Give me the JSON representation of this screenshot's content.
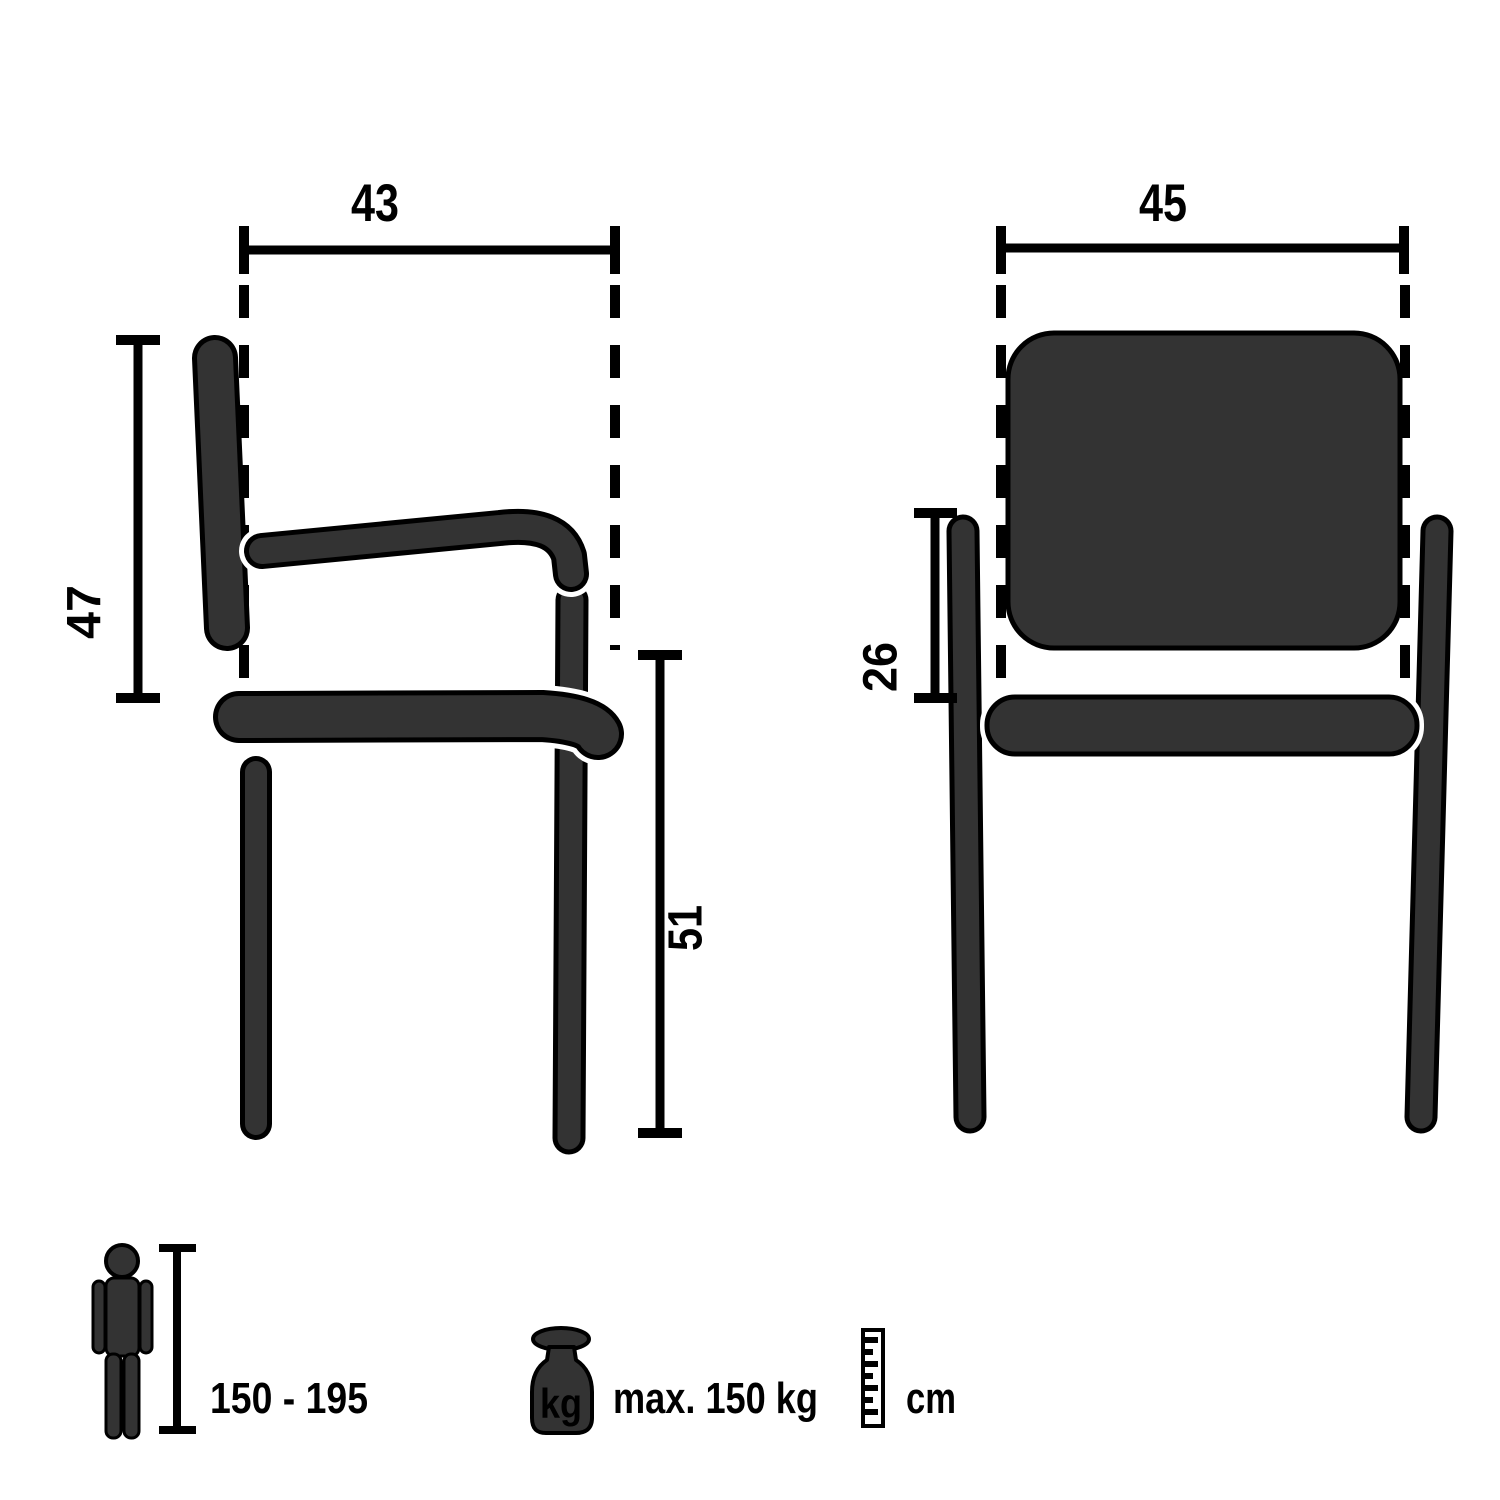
{
  "diagram": {
    "title": "chair-dimensions-technical-drawing",
    "side_view": {
      "seat_depth_cm": "43",
      "backrest_height_cm": "47",
      "seat_height_cm": "51"
    },
    "front_view": {
      "seat_width_cm": "45",
      "armrest_above_seat_cm": "26"
    },
    "legend": {
      "person_height_range": "150 - 195",
      "max_load": "max. 150 kg",
      "weight_unit": "kg",
      "measure_unit": "cm"
    },
    "colors": {
      "chair_fill": "#333333",
      "outline": "#000000",
      "background": "#ffffff"
    }
  }
}
